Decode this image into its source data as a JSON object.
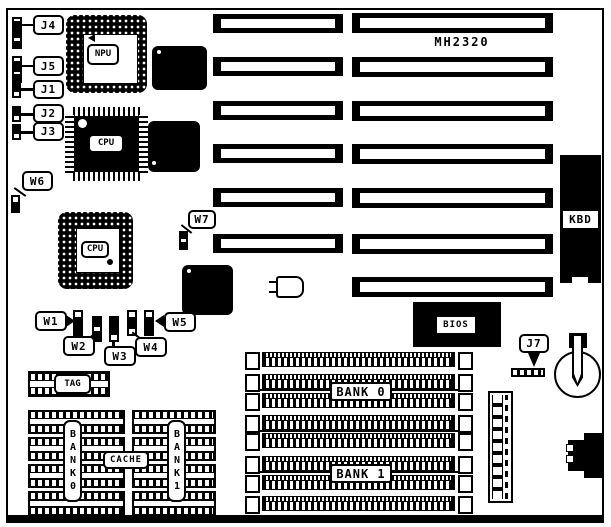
{
  "board": {
    "model": "MH2320"
  },
  "labels": {
    "j1": "J1",
    "j2": "J2",
    "j3": "J3",
    "j4": "J4",
    "j5": "J5",
    "j7": "J7",
    "w1": "W1",
    "w2": "W2",
    "w3": "W3",
    "w4": "W4",
    "w5": "W5",
    "w6": "W6",
    "w7": "W7",
    "npu": "NPU",
    "cpu_qfp": "CPU",
    "cpu_pga": "CPU",
    "tag": "TAG",
    "cache": "CACHE",
    "dip_bank0": "BANK0",
    "dip_bank1": "BANK1",
    "simm_bank0": "BANK 0",
    "simm_bank1": "BANK 1",
    "bios": "BIOS",
    "kbd": "KBD"
  },
  "colors": {
    "ink": "#000000",
    "paper": "#ffffff"
  }
}
